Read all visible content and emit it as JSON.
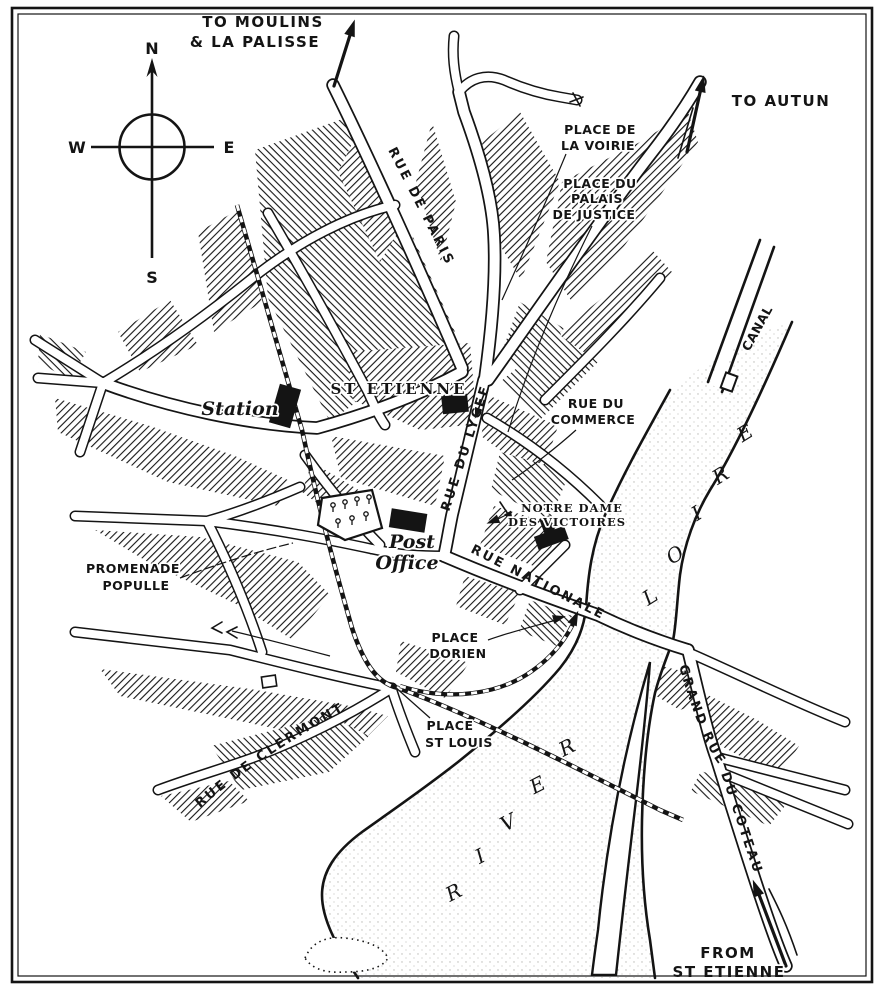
{
  "compass": {
    "n": "N",
    "s": "S",
    "e": "E",
    "w": "W"
  },
  "routes": {
    "moulins1": "TO MOULINS",
    "moulins2": "& LA PALISSE",
    "autun": "TO AUTUN",
    "from1": "FROM",
    "from2": "ST ETIENNE"
  },
  "streets": {
    "paris": "RUE DE PARIS",
    "lycee": "RUE DU LYCEE",
    "commerce1": "RUE DU",
    "commerce2": "COMMERCE",
    "nationale": "RUE NATIONALE",
    "clermont": "RUE DE CLERMONT",
    "coteau": "GRAND RUE DU COTEAU"
  },
  "places": {
    "voirie1": "PLACE DE",
    "voirie2": "LA VOIRIE",
    "palais1": "PLACE DU",
    "palais2": "PALAIS",
    "palais3": "DE JUSTICE",
    "dorien1": "PLACE",
    "dorien2": "DORIEN",
    "stlouis1": "PLACE",
    "stlouis2": "ST LOUIS",
    "promenade1": "PROMENADE",
    "promenade2": "POPULLE"
  },
  "buildings": {
    "station": "Station",
    "school": "ST ETIENNE",
    "post1": "Post",
    "post2": "Office",
    "notredame1": "NOTRE DAME",
    "notredame2": "DES VICTOIRES"
  },
  "water": {
    "canal": "CANAL",
    "loire": "LOIRE",
    "river": "RIVER"
  },
  "colors": {
    "ink": "#141414",
    "paper": "#ffffff"
  }
}
